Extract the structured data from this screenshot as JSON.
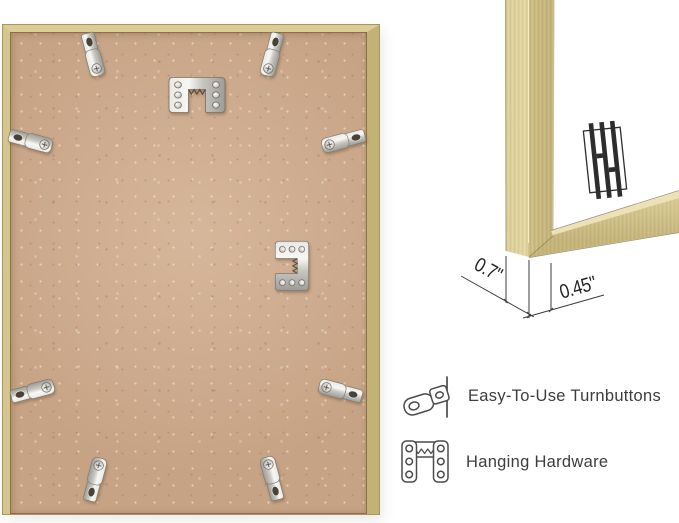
{
  "colors": {
    "gold": "#d5c58d",
    "gold_dark": "#c2b276",
    "board_tan": "#c7a385",
    "ink": "#3d3d3d",
    "background": "#ffffff"
  },
  "back_view_photo": {
    "turnbutton_count": 8,
    "sawtooth_hanger_count": 2
  },
  "corner_view_photo": {
    "brand_logo_monogram": "HH",
    "depth_label": "0.7\"",
    "face_width_label": "0.45\""
  },
  "features": [
    {
      "icon": "turnbutton-icon",
      "label": "Easy-To-Use Turnbuttons"
    },
    {
      "icon": "hanging-hardware-icon",
      "label": "Hanging Hardware"
    }
  ]
}
